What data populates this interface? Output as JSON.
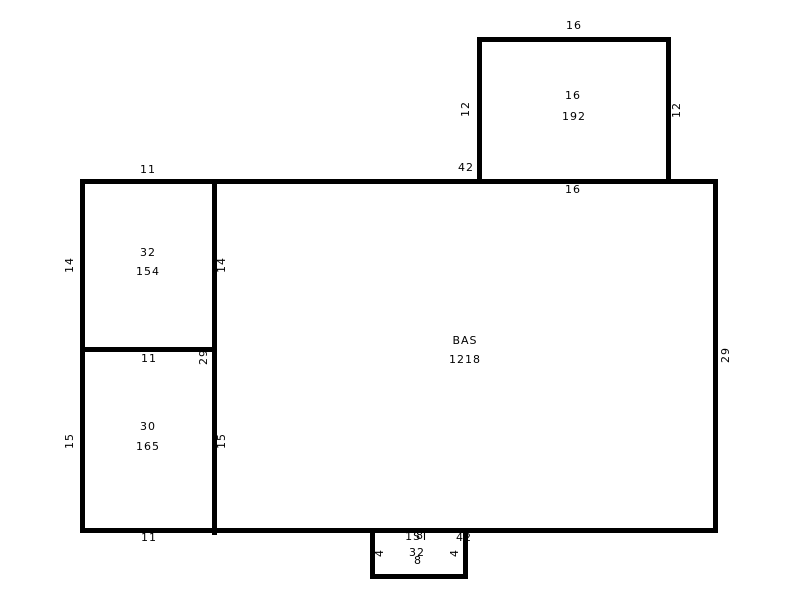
{
  "sketch": {
    "colors": {
      "line": "#000000",
      "background": "#ffffff",
      "text": "#000000"
    },
    "areas": {
      "base": {
        "code": "BAS",
        "area": "1218"
      },
      "left_upper": {
        "code": "32",
        "area": "154"
      },
      "left_lower": {
        "code": "30",
        "area": "165"
      },
      "upper_addition": {
        "code": "16",
        "area": "192"
      },
      "stoop": {
        "code": "1ST",
        "area": "32"
      }
    },
    "dims": {
      "upper_addition_top": "16",
      "upper_addition_left": "12",
      "upper_addition_right": "12",
      "upper_addition_bottom": "16",
      "base_top": "42",
      "base_left": "29",
      "base_right": "29",
      "base_bottom": "42",
      "left_upper_top": "11",
      "left_upper_left": "14",
      "left_upper_right": "14",
      "left_upper_bottom": "11",
      "left_lower_left": "15",
      "left_lower_right": "15",
      "left_lower_bottom": "11",
      "stoop_top": "8",
      "stoop_bottom": "8",
      "stoop_left": "4",
      "stoop_right": "4"
    }
  }
}
